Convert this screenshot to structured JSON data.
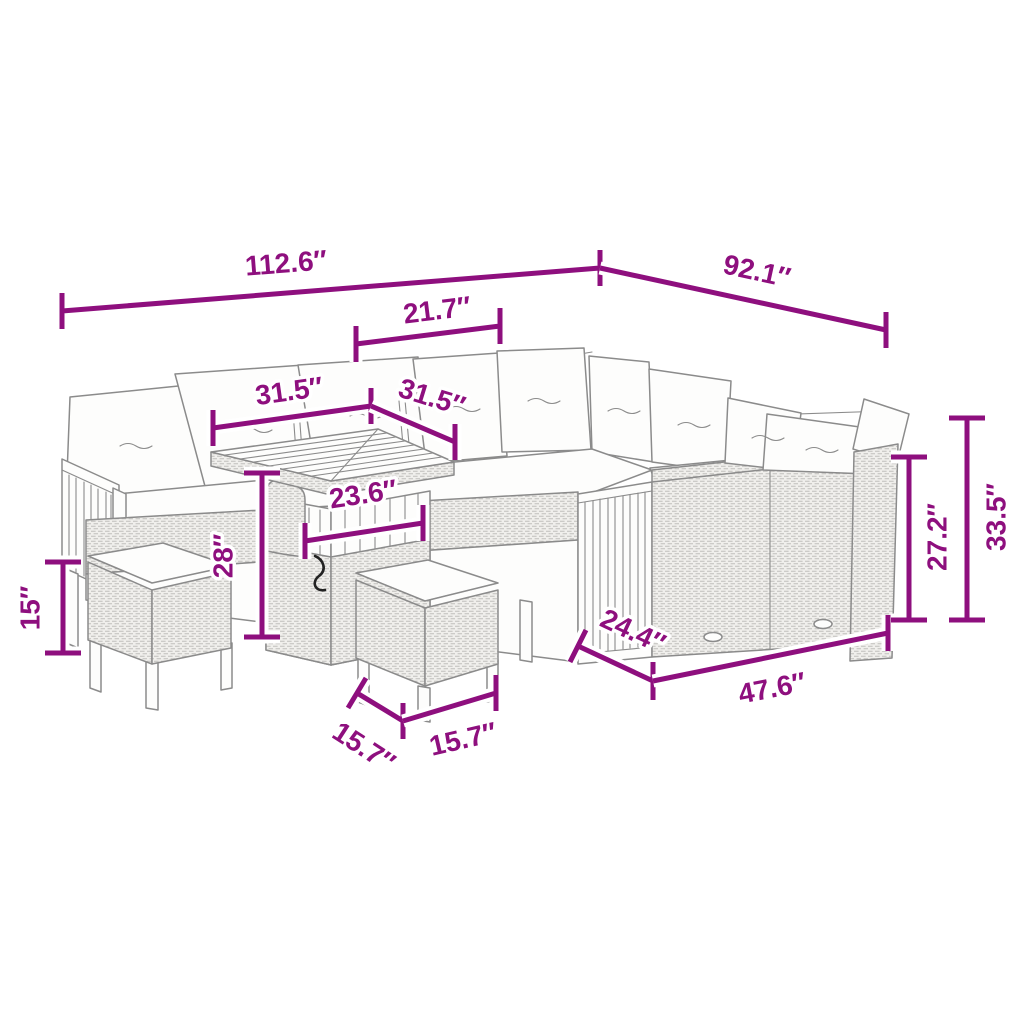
{
  "diagram": {
    "background_color": "#ffffff",
    "dimension_color": "#8E0F7E",
    "drawing_color": "#8b8b8b",
    "unit_mark": "″",
    "dims": {
      "overall_left": {
        "label": "112.6″",
        "value": 112.6
      },
      "overall_right": {
        "label": "92.1″",
        "value": 92.1
      },
      "corner_width": {
        "label": "21.7″",
        "value": 21.7
      },
      "table_width": {
        "label": "31.5″",
        "value": 31.5
      },
      "table_depth": {
        "label": "31.5″",
        "value": 31.5
      },
      "table_base_width": {
        "label": "23.6″",
        "value": 23.6
      },
      "table_height": {
        "label": "28″",
        "value": 28
      },
      "stool_height": {
        "label": "15″",
        "value": 15
      },
      "stool_depth": {
        "label": "15.7″",
        "value": 15.7
      },
      "stool_width": {
        "label": "15.7″",
        "value": 15.7
      },
      "sofa_depth": {
        "label": "24.4″",
        "value": 24.4
      },
      "sofa_front_width": {
        "label": "47.6″",
        "value": 47.6
      },
      "back_height": {
        "label": "27.2″",
        "value": 27.2
      },
      "total_height": {
        "label": "33.5″",
        "value": 33.5
      }
    }
  }
}
